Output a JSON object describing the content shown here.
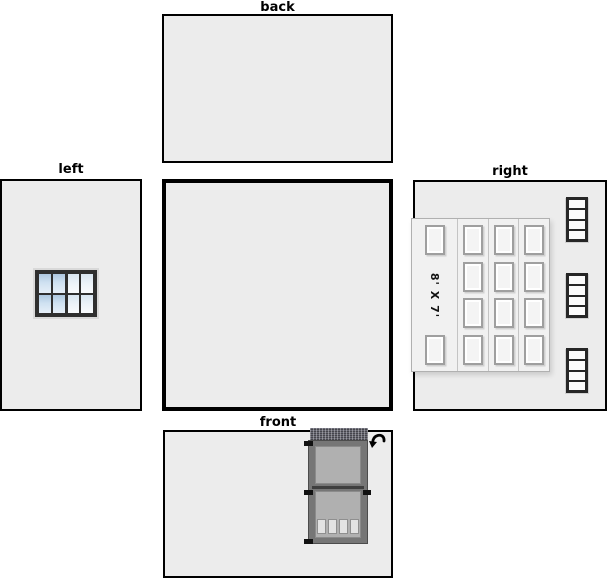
{
  "labels": {
    "back": "back",
    "left": "left",
    "right": "right",
    "front": "front"
  },
  "left_window": {
    "sashes": 2,
    "cols_per_sash": 2,
    "rows": 2
  },
  "garage_door": {
    "size_label": "8' X 7'",
    "columns": 4,
    "panels_per_column": 4
  },
  "small_windows": {
    "count": 3,
    "panes_per_window": 4
  },
  "front_door": {
    "lites": 4,
    "hinges": 3,
    "swing_icon": "curved-arrow-icon"
  },
  "colors": {
    "wall_fill": "#ececec",
    "wall_border": "#000000",
    "window_frame": "#2f2f2f",
    "pane_blue": "#cfe1f1",
    "garage_fill": "#f1f1f1",
    "door_frame": "#767676",
    "door_panel": "#b0b0b0"
  }
}
